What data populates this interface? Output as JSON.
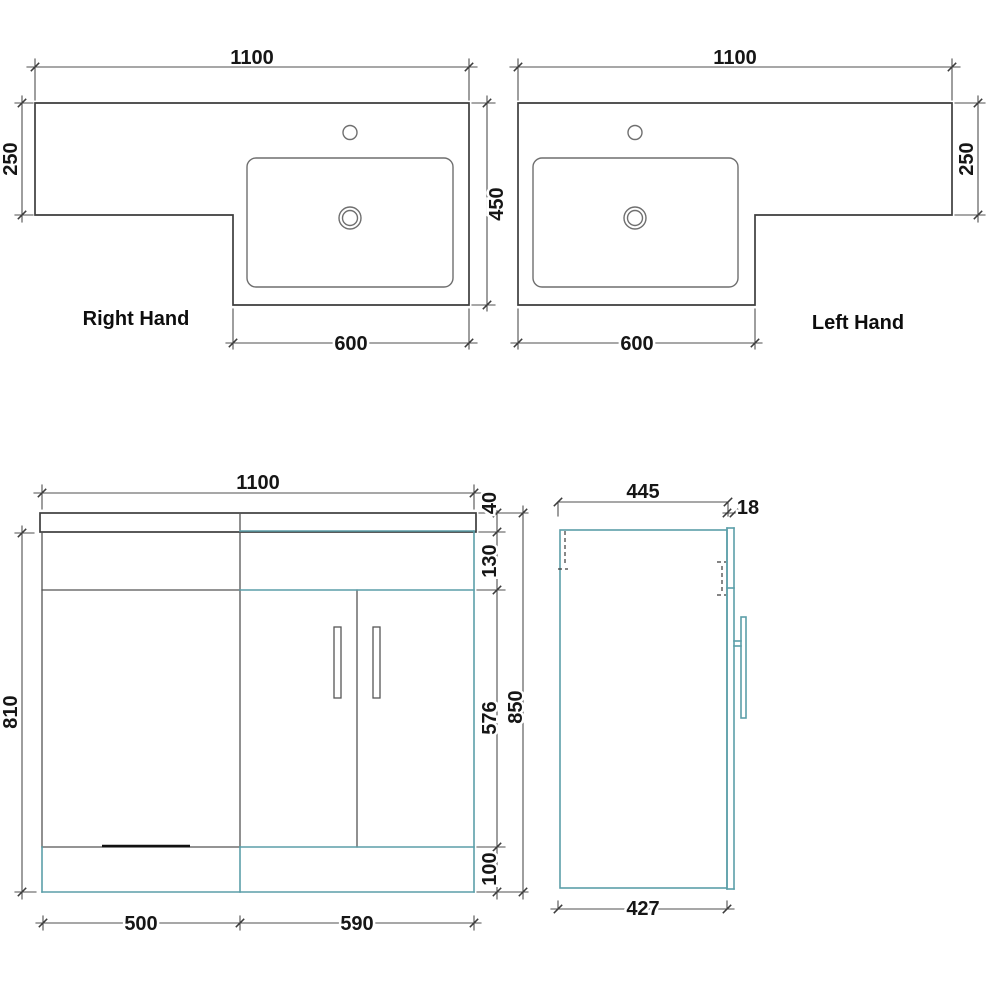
{
  "document_title": "L-shaped vanity unit technical drawing",
  "colors": {
    "cabinet_line_teal": "#5b9ea8",
    "drawing_line": "#4f4f4f",
    "dim_text": "#161616",
    "background": "#ffffff"
  },
  "plan_right": {
    "title": "Right Hand",
    "width": "1100",
    "left_depth": "250",
    "basin_depth": "450",
    "basin_width": "600"
  },
  "plan_left": {
    "title": "Left Hand",
    "width": "1100",
    "right_depth": "250",
    "basin_width": "600"
  },
  "front": {
    "width": "1100",
    "worktop": "40",
    "upper": "130",
    "doors": "576",
    "plinth": "100",
    "height_total": "850",
    "height_carcass": "810",
    "left_section": "500",
    "right_section": "590"
  },
  "side": {
    "depth_total": "445",
    "door_thickness": "18",
    "depth_carcass": "427"
  }
}
